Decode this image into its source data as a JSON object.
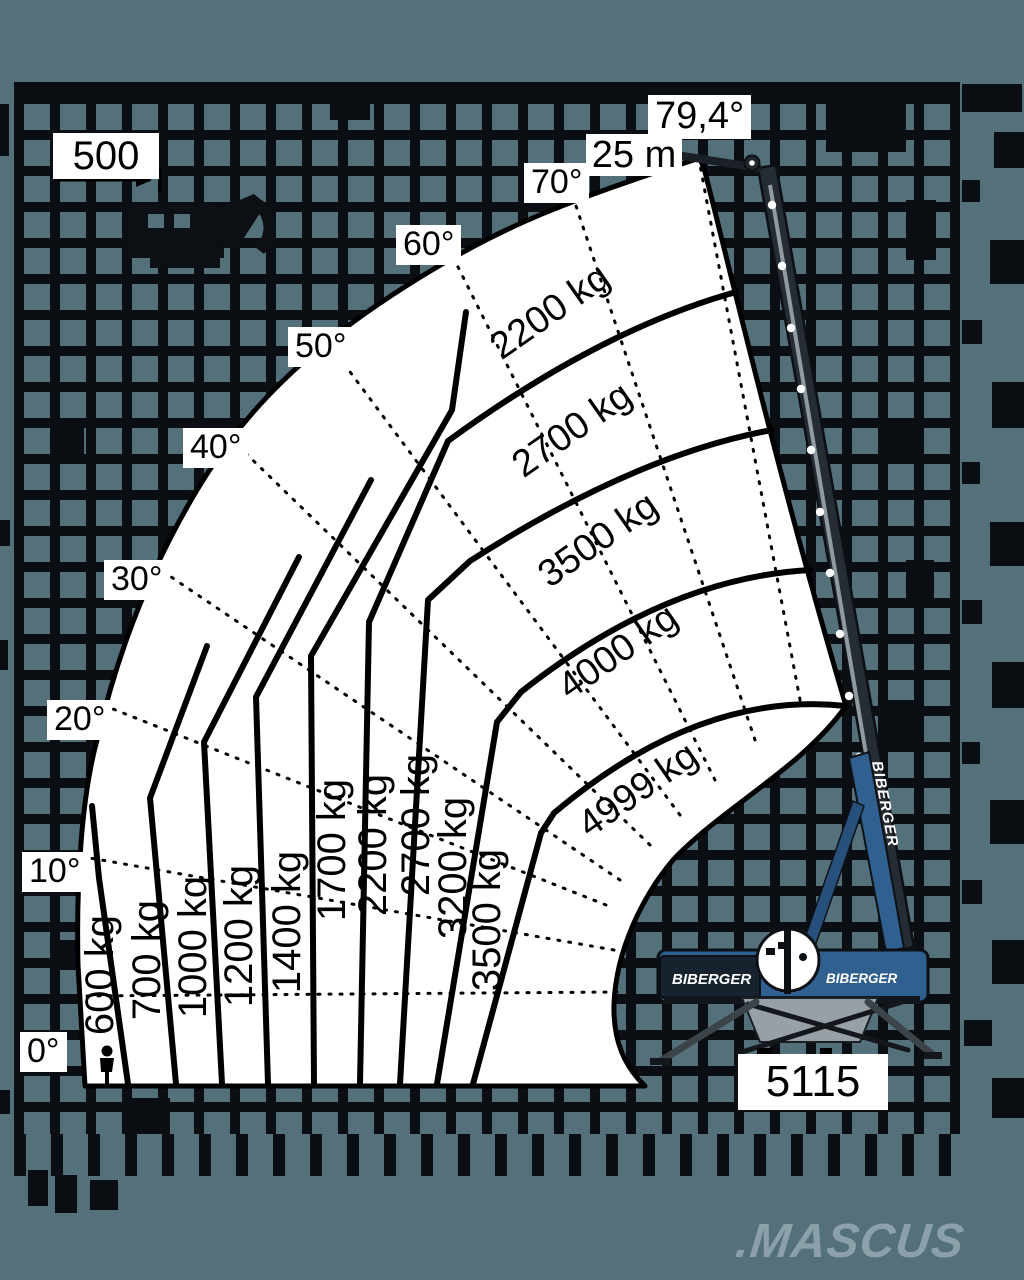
{
  "colors": {
    "background": "#53707b",
    "grid_line": "#0b0e12",
    "fan_fill": "#ffffff",
    "line_color": "#000000",
    "crane_blue": "#2f608f",
    "crane_dark": "#23282e",
    "watermark": "#8ba0a8"
  },
  "watermark": {
    "text": ".MASCUS"
  },
  "brand": {
    "name": "BIBERGER",
    "boom_text": "BIBERGER",
    "chassis_left_text": "BIBERGER",
    "chassis_right_text": "BIBERGER"
  },
  "chart_data": {
    "type": "crane-load-diagram",
    "description": "Telescopic crane working range and load capacity fan diagram on tiled wall background",
    "boom_length_label": "25 m",
    "max_boom_angle_label": "79,4°",
    "tail_dimension_label": "500",
    "outrigger_span_label": "5115",
    "angle_ticks_deg": [
      0,
      10,
      20,
      30,
      40,
      50,
      60,
      70,
      79.4
    ],
    "angle_labels": [
      {
        "text": "0°",
        "x": 20,
        "y": 1032
      },
      {
        "text": "10°",
        "x": 22,
        "y": 852
      },
      {
        "text": "20°",
        "x": 47,
        "y": 700
      },
      {
        "text": "30°",
        "x": 104,
        "y": 560
      },
      {
        "text": "40°",
        "x": 183,
        "y": 428
      },
      {
        "text": "50°",
        "x": 288,
        "y": 327
      },
      {
        "text": "60°",
        "x": 396,
        "y": 225
      },
      {
        "text": "70°",
        "x": 524,
        "y": 163
      },
      {
        "text": "79,4°",
        "x": 648,
        "y": 95,
        "fs": 38
      }
    ],
    "column_capacities_kg": [
      600,
      700,
      1000,
      1200,
      1400,
      1700,
      2200,
      2700,
      3200,
      3500
    ],
    "column_labels": [
      {
        "text": "600 kg",
        "x": 100,
        "y": 975
      },
      {
        "text": "700 kg",
        "x": 147,
        "y": 960
      },
      {
        "text": "1000 kg",
        "x": 193,
        "y": 947
      },
      {
        "text": "1200 kg",
        "x": 239,
        "y": 936
      },
      {
        "text": "1400 kg",
        "x": 287,
        "y": 922
      },
      {
        "text": "1700 kg",
        "x": 332,
        "y": 850
      },
      {
        "text": "2200 kg",
        "x": 373,
        "y": 845
      },
      {
        "text": "2700 kg",
        "x": 416,
        "y": 825
      },
      {
        "text": "3200 kg",
        "x": 453,
        "y": 868
      },
      {
        "text": "3500 kg",
        "x": 487,
        "y": 920
      }
    ],
    "arc_capacities_kg": [
      2200,
      2700,
      3500,
      4000,
      4999
    ],
    "arc_labels": [
      {
        "text": "2200 kg",
        "x": 550,
        "y": 312
      },
      {
        "text": "2700 kg",
        "x": 572,
        "y": 430
      },
      {
        "text": "3500 kg",
        "x": 598,
        "y": 540
      },
      {
        "text": "4000 kg",
        "x": 618,
        "y": 652
      },
      {
        "text": "4999 kg",
        "x": 638,
        "y": 790
      }
    ],
    "dim_labels": [
      {
        "text": "500",
        "x": 53,
        "y": 133,
        "w": 106,
        "h": 46,
        "fs": 40
      },
      {
        "text": "25 m",
        "x": 586,
        "y": 134,
        "w": 96,
        "h": 42,
        "fs": 38
      },
      {
        "text": "5115",
        "x": 738,
        "y": 1054,
        "w": 150,
        "h": 56,
        "fs": 44
      }
    ]
  }
}
